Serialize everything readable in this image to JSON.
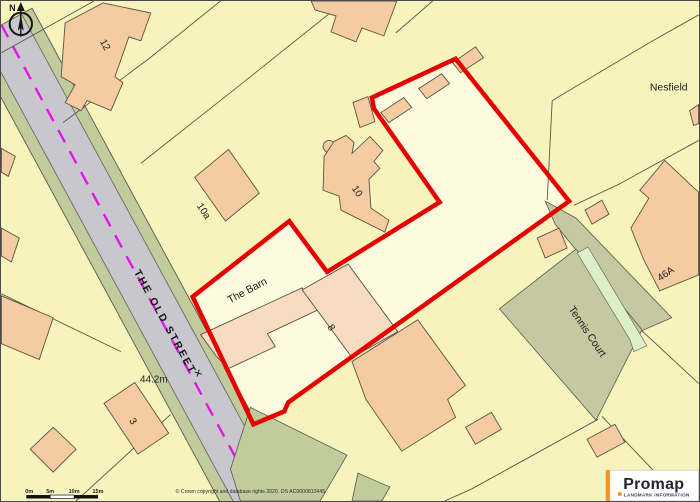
{
  "map": {
    "parcel_labels": [
      {
        "text": "12"
      },
      {
        "text": "10a"
      },
      {
        "text": "10"
      },
      {
        "text": "8"
      },
      {
        "text": "3"
      },
      {
        "text": "46A"
      },
      {
        "text": "Nesfield"
      },
      {
        "text": "The Barn"
      },
      {
        "text": "Tennis Court"
      }
    ],
    "road": {
      "name": "THE OLD STREET",
      "benchmark_cross": "✕",
      "spot_height": "44.2m"
    },
    "compass_north": "N",
    "scale_bar_ticks": [
      "0m",
      "5m",
      "10m",
      "15m"
    ],
    "copyright": "© Crown copyright and database rights 2020. OS AC0000813445",
    "branding": {
      "logo_text": "Promap",
      "tagline": "LANDMARK INFORMATION"
    },
    "colors": {
      "site_boundary_red": "#E60000",
      "road_centerline_magenta": "#E515E5",
      "building_fill": "#F5CBA2",
      "building_fill_light": "#F8DBC0",
      "road_gray": "#C8C7CE",
      "verge_olive": "#C2CB9C",
      "tennis_court_olive": "#C5C9A2",
      "path_light_green": "#DCEFC8",
      "background_yellow": "#F7F3BD",
      "site_interior_cream": "#FCFADF",
      "promap_orange": "#F7941D"
    }
  }
}
